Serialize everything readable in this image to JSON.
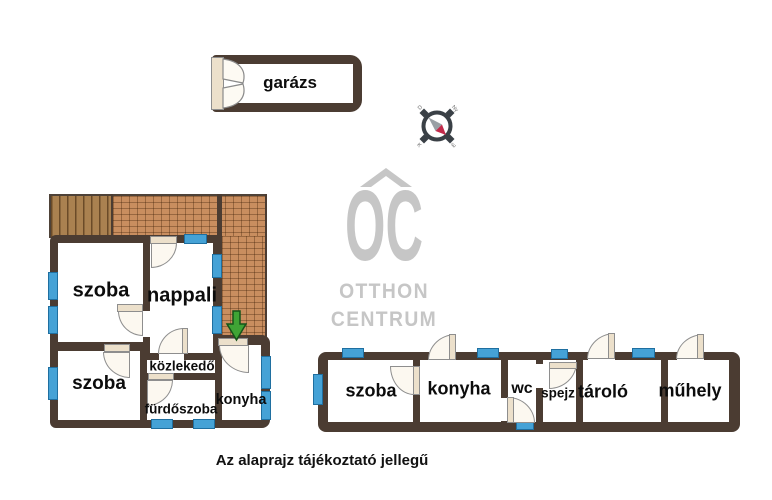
{
  "caption": "Az alaprajz tájékoztató jellegű",
  "garage": {
    "label": "garázs"
  },
  "left_house": {
    "rooms": [
      {
        "name": "szoba-1",
        "label": "szoba"
      },
      {
        "name": "nappali",
        "label": "nappali"
      },
      {
        "name": "szoba-2",
        "label": "szoba"
      },
      {
        "name": "kozlekedo",
        "label": "közlekedő"
      },
      {
        "name": "furdoszoba",
        "label": "fürdőszoba"
      },
      {
        "name": "konyha",
        "label": "konyha"
      }
    ]
  },
  "right_building": {
    "rooms": [
      {
        "name": "szoba",
        "label": "szoba"
      },
      {
        "name": "konyha",
        "label": "konyha"
      },
      {
        "name": "wc",
        "label": "wc"
      },
      {
        "name": "spejz",
        "label": "spejz"
      },
      {
        "name": "tarolo",
        "label": "tároló"
      },
      {
        "name": "muhely",
        "label": "műhely"
      }
    ]
  },
  "logo": {
    "initials": "OC",
    "line1": "OTTHON",
    "line2": "CENTRUM"
  },
  "compass": {
    "nw": "D",
    "ne": "Ny",
    "sw": "K",
    "se": "É"
  },
  "colors": {
    "wall": "#4b3c32",
    "window_blue": "#45a2d6",
    "door_leaf": "#ece0cb",
    "terrace_brick": "#c98e5f",
    "deck_wood": "#aa8150",
    "logo_gray": "#c6c6c6",
    "arrow_green": "#3fa435",
    "compass_red": "#c22a4a"
  }
}
